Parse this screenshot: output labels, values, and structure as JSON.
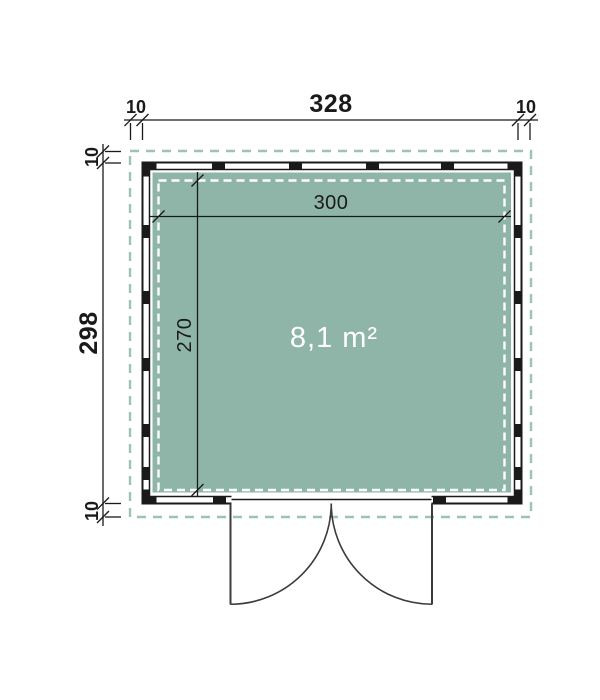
{
  "labels": {
    "overall_width": "328",
    "overall_height": "298",
    "interior_width": "300",
    "interior_height": "270",
    "overhang_top_left": "10",
    "overhang_top_right": "10",
    "overhang_left_top": "10",
    "overhang_left_bottom": "10",
    "area": "8,1 m²"
  },
  "colors": {
    "line": "#1a1a1a",
    "floor": "#8fb5a9",
    "roof_outline": "#9ec3b6",
    "inner_dash": "#ffffff",
    "door": "#3c3c3c"
  }
}
